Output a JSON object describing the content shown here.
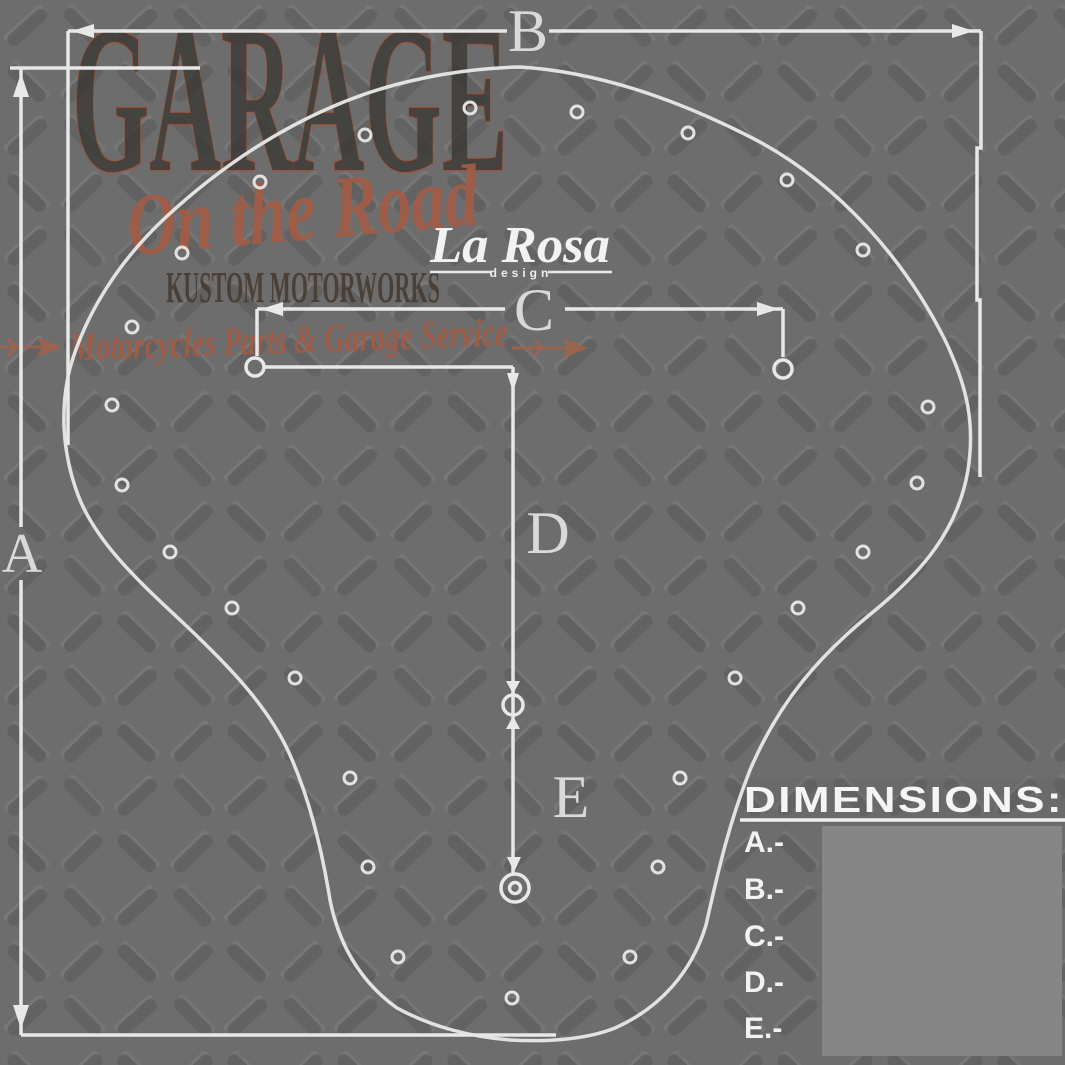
{
  "watermark": {
    "title": "GARAGE",
    "subtitle": "On the Road",
    "line3": "KUSTOM MOTORWORKS",
    "tagline": "Motorcycles Parts & Garage Service"
  },
  "brand": {
    "name": "La Rosa",
    "sub": "design"
  },
  "dimension_labels": {
    "a": "A",
    "b": "B",
    "c": "C",
    "d": "D",
    "e": "E"
  },
  "legend": {
    "title": "DIMENSIONS:",
    "items": [
      "A.-",
      "B.-",
      "C.-",
      "D.-",
      "E.-"
    ]
  },
  "colors": {
    "plate_base": "#6d6d6d",
    "plate_tread_dark": "#606060",
    "plate_tread_light": "#7b7b7b",
    "diagram_line": "#e8e8e8",
    "dimension_letter": "#d9d9d9",
    "rust_accent": "#a25c45",
    "watermark_dark": "#3a3733",
    "legend_panel": "#868686",
    "legend_text": "#f5f5f5"
  }
}
